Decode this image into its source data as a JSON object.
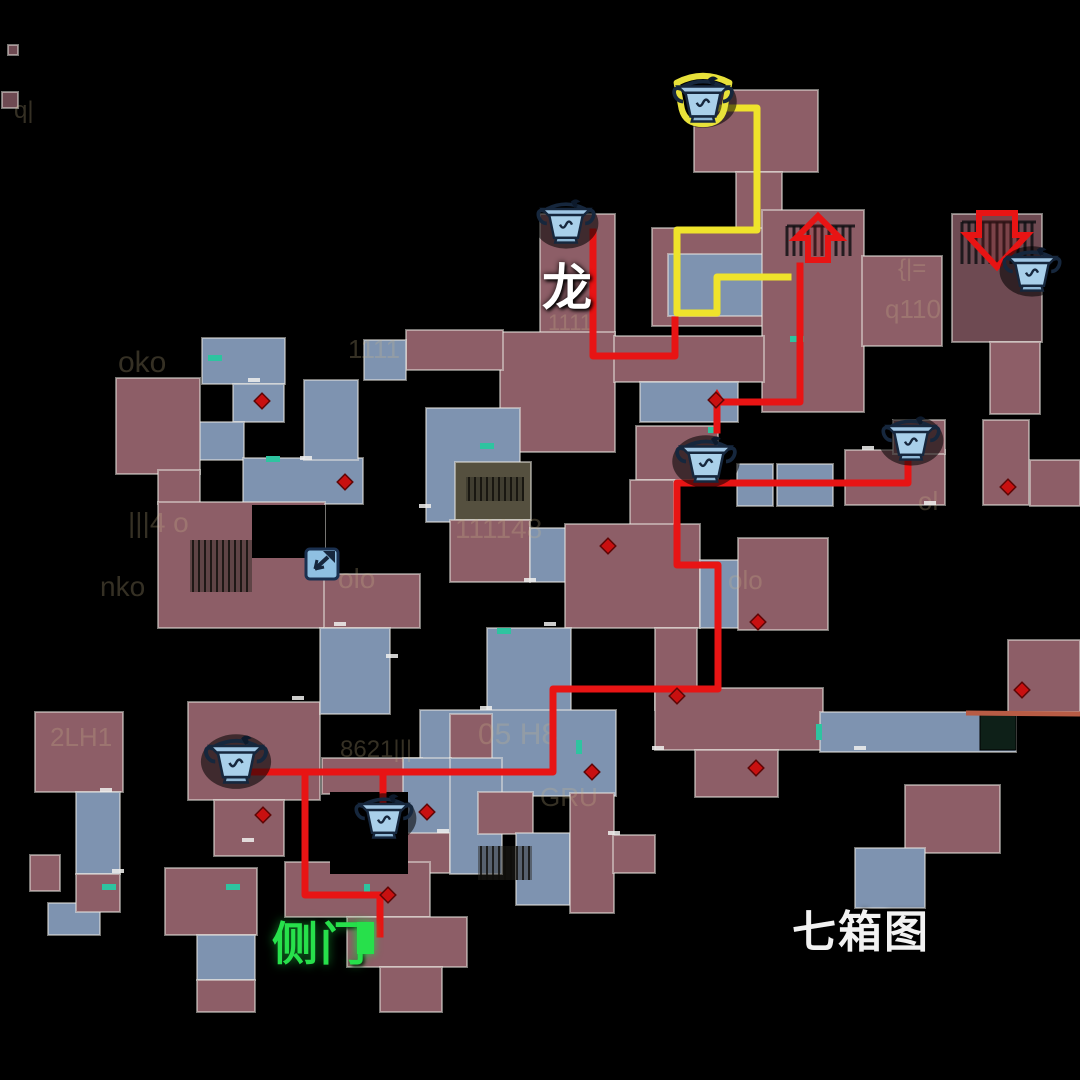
{
  "map": {
    "title_note": "seven chest map overlay",
    "colors": {
      "background": "#000000",
      "room_pink": "#8d5e67",
      "room_blue": "#7e93b0",
      "room_dark": "#6e4a52",
      "room_olive": "#55503f",
      "room_border": "rgba(235,233,228,0.5)",
      "path_red": "#e81414",
      "path_yellow": "#efe32b",
      "door_teal": "#2ec4a0",
      "marker_red": "#c81010",
      "side_door_green": "#27e04b",
      "orange_line": "#b85c45",
      "ghost_text": "#cdb98a",
      "chest_body": "#a9d0ea",
      "chest_outline": "#16273d",
      "chest_highlight": "#e8e13a"
    },
    "labels": [
      {
        "text": "龙",
        "x": 542,
        "y": 248,
        "color": "#ffffff"
      },
      {
        "text": "侧门",
        "x": 272,
        "y": 908,
        "color": "#27e04b"
      },
      {
        "text": "七箱图",
        "x": 792,
        "y": 896,
        "color": "#f2f2f2"
      }
    ],
    "rooms": [
      [
        694,
        90,
        124,
        82,
        "p"
      ],
      [
        736,
        172,
        46,
        58,
        "p"
      ],
      [
        652,
        228,
        180,
        98,
        "p"
      ],
      [
        668,
        254,
        100,
        62,
        "b"
      ],
      [
        762,
        210,
        102,
        202,
        "p"
      ],
      [
        862,
        256,
        80,
        90,
        "p"
      ],
      [
        952,
        214,
        90,
        128,
        "d"
      ],
      [
        540,
        214,
        75,
        122,
        "p"
      ],
      [
        500,
        332,
        115,
        120,
        "p"
      ],
      [
        406,
        330,
        97,
        40,
        "p"
      ],
      [
        614,
        336,
        150,
        46,
        "p"
      ],
      [
        640,
        382,
        98,
        40,
        "b"
      ],
      [
        202,
        338,
        83,
        46,
        "b"
      ],
      [
        233,
        384,
        51,
        38,
        "b"
      ],
      [
        198,
        422,
        46,
        38,
        "b"
      ],
      [
        243,
        458,
        120,
        46,
        "b"
      ],
      [
        116,
        378,
        84,
        96,
        "p"
      ],
      [
        158,
        470,
        42,
        34,
        "p"
      ],
      [
        304,
        380,
        54,
        80,
        "b"
      ],
      [
        364,
        340,
        42,
        40,
        "b"
      ],
      [
        158,
        502,
        167,
        126,
        "p"
      ],
      [
        324,
        574,
        96,
        54,
        "p"
      ],
      [
        426,
        408,
        94,
        114,
        "b"
      ],
      [
        455,
        462,
        76,
        58,
        "o"
      ],
      [
        450,
        520,
        80,
        62,
        "p"
      ],
      [
        530,
        528,
        36,
        54,
        "b"
      ],
      [
        636,
        426,
        82,
        54,
        "p"
      ],
      [
        630,
        480,
        44,
        92,
        "p"
      ],
      [
        737,
        464,
        36,
        42,
        "b"
      ],
      [
        777,
        464,
        56,
        42,
        "b"
      ],
      [
        845,
        450,
        100,
        55,
        "p"
      ],
      [
        893,
        420,
        52,
        34,
        "p"
      ],
      [
        983,
        420,
        46,
        85,
        "p"
      ],
      [
        1030,
        460,
        50,
        46,
        "p"
      ],
      [
        990,
        342,
        50,
        72,
        "p"
      ],
      [
        565,
        524,
        135,
        104,
        "p"
      ],
      [
        700,
        560,
        60,
        68,
        "b"
      ],
      [
        738,
        538,
        90,
        92,
        "p"
      ],
      [
        655,
        628,
        42,
        82,
        "p"
      ],
      [
        655,
        688,
        168,
        62,
        "p"
      ],
      [
        695,
        750,
        83,
        47,
        "p"
      ],
      [
        820,
        712,
        196,
        40,
        "b"
      ],
      [
        1008,
        640,
        72,
        72,
        "p"
      ],
      [
        905,
        785,
        95,
        68,
        "p"
      ],
      [
        855,
        848,
        70,
        60,
        "b"
      ],
      [
        188,
        702,
        132,
        98,
        "p"
      ],
      [
        214,
        800,
        70,
        56,
        "p"
      ],
      [
        320,
        628,
        70,
        86,
        "b"
      ],
      [
        487,
        628,
        84,
        84,
        "b"
      ],
      [
        420,
        710,
        196,
        86,
        "b"
      ],
      [
        450,
        714,
        42,
        86,
        "p"
      ],
      [
        322,
        758,
        100,
        36,
        "p"
      ],
      [
        403,
        758,
        48,
        78,
        "b"
      ],
      [
        407,
        833,
        43,
        40,
        "p"
      ],
      [
        450,
        758,
        52,
        116,
        "b"
      ],
      [
        478,
        792,
        55,
        42,
        "p"
      ],
      [
        516,
        833,
        54,
        72,
        "b"
      ],
      [
        570,
        793,
        44,
        120,
        "p"
      ],
      [
        613,
        835,
        42,
        38,
        "p"
      ],
      [
        285,
        862,
        145,
        55,
        "p"
      ],
      [
        347,
        917,
        120,
        50,
        "p"
      ],
      [
        380,
        967,
        62,
        45,
        "p"
      ],
      [
        165,
        868,
        92,
        67,
        "p"
      ],
      [
        197,
        935,
        58,
        45,
        "b"
      ],
      [
        197,
        980,
        58,
        32,
        "p"
      ],
      [
        48,
        903,
        52,
        32,
        "b"
      ],
      [
        35,
        712,
        88,
        80,
        "p"
      ],
      [
        76,
        792,
        44,
        82,
        "b"
      ],
      [
        76,
        874,
        44,
        38,
        "p"
      ],
      [
        30,
        855,
        30,
        36,
        "p"
      ],
      [
        2,
        92,
        16,
        16,
        "d"
      ],
      [
        8,
        45,
        10,
        10,
        "d"
      ]
    ],
    "holes": [
      [
        252,
        505,
        73,
        53
      ],
      [
        330,
        792,
        78,
        82
      ]
    ],
    "dark_square": [
      980,
      714,
      36,
      36
    ],
    "stairs": [
      [
        190,
        540,
        62,
        52
      ],
      [
        466,
        477,
        58,
        24
      ],
      [
        478,
        846,
        54,
        34
      ]
    ],
    "grates": [
      [
        787,
        226,
        68,
        30
      ],
      [
        962,
        222,
        74,
        42
      ]
    ],
    "paths": [
      {
        "name": "yellow-route",
        "color": "yellow",
        "width": 7,
        "points": [
          [
            703,
            108
          ],
          [
            757,
            108
          ],
          [
            757,
            230
          ],
          [
            677,
            230
          ],
          [
            677,
            313
          ],
          [
            717,
            313
          ],
          [
            717,
            277
          ],
          [
            788,
            277
          ]
        ]
      },
      {
        "name": "red-route-dragon",
        "color": "red",
        "width": 7,
        "points": [
          [
            593,
            232
          ],
          [
            593,
            356
          ],
          [
            675,
            356
          ],
          [
            675,
            320
          ]
        ]
      },
      {
        "name": "red-route-exit",
        "color": "red",
        "width": 7,
        "points": [
          [
            717,
            430
          ],
          [
            717,
            402
          ],
          [
            800,
            402
          ],
          [
            800,
            266
          ]
        ]
      },
      {
        "name": "red-route-main",
        "color": "red",
        "width": 7,
        "points": [
          [
            908,
            452
          ],
          [
            908,
            483
          ],
          [
            677,
            483
          ],
          [
            677,
            565
          ],
          [
            718,
            565
          ],
          [
            718,
            689
          ],
          [
            553,
            689
          ],
          [
            553,
            772
          ],
          [
            253,
            772
          ]
        ]
      },
      {
        "name": "red-branch-chest",
        "color": "red",
        "width": 7,
        "points": [
          [
            383,
            772
          ],
          [
            383,
            806
          ]
        ]
      },
      {
        "name": "red-branch-sidedoor",
        "color": "red",
        "width": 7,
        "points": [
          [
            305,
            772
          ],
          [
            305,
            895
          ],
          [
            380,
            895
          ],
          [
            380,
            934
          ]
        ]
      }
    ],
    "small_arrowhead": {
      "x": 717,
      "y": 396,
      "dir": "up"
    },
    "big_arrows": [
      {
        "x": 788,
        "y": 208,
        "dir": "up"
      },
      {
        "x": 965,
        "y": 205,
        "dir": "down"
      }
    ],
    "chests": [
      {
        "x": 703,
        "y": 99,
        "scale": 1.25,
        "highlight": true
      },
      {
        "x": 566,
        "y": 221,
        "scale": 1.2,
        "highlight": false
      },
      {
        "x": 1032,
        "y": 269,
        "scale": 1.2,
        "highlight": false
      },
      {
        "x": 706,
        "y": 459,
        "scale": 1.25,
        "highlight": false
      },
      {
        "x": 911,
        "y": 438,
        "scale": 1.2,
        "highlight": false
      },
      {
        "x": 236,
        "y": 759,
        "scale": 1.3,
        "highlight": false
      },
      {
        "x": 384,
        "y": 816,
        "scale": 1.2,
        "highlight": false
      }
    ],
    "exit_icon": {
      "x": 322,
      "y": 565
    },
    "diamonds": [
      [
        262,
        401
      ],
      [
        345,
        482
      ],
      [
        608,
        546
      ],
      [
        716,
        400
      ],
      [
        677,
        696
      ],
      [
        756,
        768
      ],
      [
        592,
        772
      ],
      [
        427,
        812
      ],
      [
        263,
        815
      ],
      [
        388,
        895
      ],
      [
        758,
        622
      ],
      [
        1022,
        690
      ],
      [
        1008,
        487
      ]
    ],
    "teal_doors": [
      [
        208,
        355,
        14,
        6
      ],
      [
        266,
        456,
        14,
        6
      ],
      [
        480,
        443,
        14,
        6
      ],
      [
        708,
        427,
        12,
        6
      ],
      [
        790,
        336,
        14,
        6
      ],
      [
        816,
        724,
        6,
        16
      ],
      [
        364,
        884,
        6,
        14
      ],
      [
        226,
        884,
        14,
        6
      ],
      [
        102,
        884,
        14,
        6
      ],
      [
        497,
        628,
        14,
        6
      ],
      [
        576,
        740,
        6,
        14
      ]
    ],
    "white_ticks": [
      [
        340,
        624
      ],
      [
        392,
        656
      ],
      [
        298,
        698
      ],
      [
        248,
        840
      ],
      [
        106,
        790
      ],
      [
        118,
        871
      ],
      [
        550,
        624
      ],
      [
        486,
        708
      ],
      [
        443,
        831
      ],
      [
        614,
        833
      ],
      [
        658,
        748
      ],
      [
        860,
        748
      ],
      [
        930,
        503
      ],
      [
        868,
        448
      ],
      [
        254,
        380
      ],
      [
        306,
        458
      ],
      [
        425,
        506
      ],
      [
        530,
        580
      ]
    ],
    "orange_line": {
      "x1": 966,
      "y1": 713,
      "x2": 1080,
      "y2": 714
    },
    "side_door_block": {
      "x": 357,
      "y": 922,
      "w": 17,
      "h": 32
    },
    "ghost_texts": [
      {
        "text": "oko",
        "x": 118,
        "y": 372,
        "s": 30
      },
      {
        "text": "1111",
        "x": 348,
        "y": 358,
        "s": 26
      },
      {
        "text": "|||4 o",
        "x": 128,
        "y": 532,
        "s": 28
      },
      {
        "text": "olo",
        "x": 338,
        "y": 588,
        "s": 28
      },
      {
        "text": "nko",
        "x": 100,
        "y": 596,
        "s": 28
      },
      {
        "text": "111148",
        "x": 455,
        "y": 538,
        "s": 28
      },
      {
        "text": "05 H8",
        "x": 478,
        "y": 744,
        "s": 30
      },
      {
        "text": "GRU",
        "x": 540,
        "y": 806,
        "s": 26
      },
      {
        "text": "q110",
        "x": 885,
        "y": 318,
        "s": 26
      },
      {
        "text": "{|=",
        "x": 898,
        "y": 276,
        "s": 24
      },
      {
        "text": "2LH1",
        "x": 50,
        "y": 746,
        "s": 26
      },
      {
        "text": "olo",
        "x": 728,
        "y": 589,
        "s": 26
      },
      {
        "text": "ol",
        "x": 918,
        "y": 510,
        "s": 26
      },
      {
        "text": "8621|||",
        "x": 340,
        "y": 757,
        "s": 24
      },
      {
        "text": "1111",
        "x": 548,
        "y": 330,
        "s": 22
      },
      {
        "text": "q|",
        "x": 14,
        "y": 118,
        "s": 24
      }
    ]
  }
}
